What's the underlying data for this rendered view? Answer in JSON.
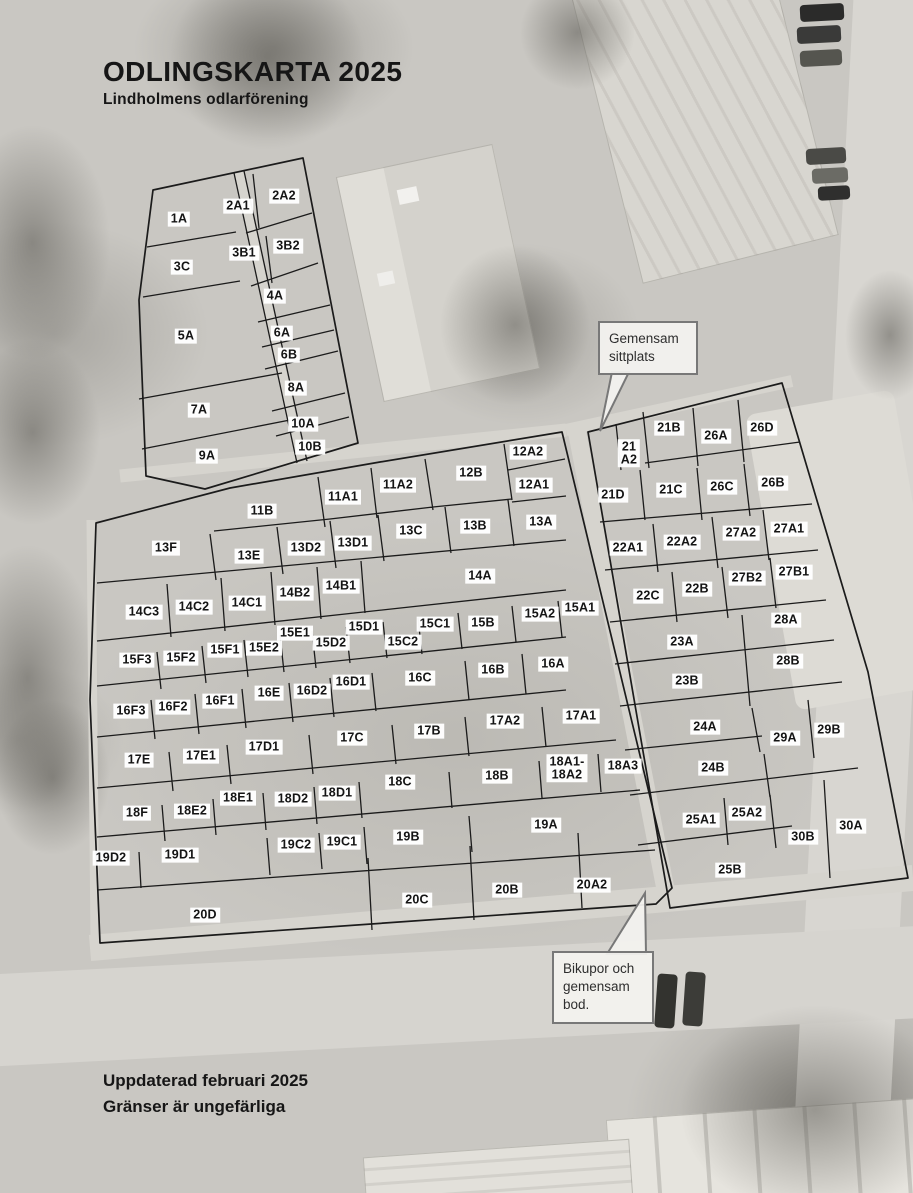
{
  "page": {
    "title": "ODLINGSKARTA 2025",
    "subtitle": "Lindholmens odlarförening",
    "footer_line1": "Uppdaterad februari 2025",
    "footer_line2": "Gränser är ungefärliga"
  },
  "callouts": {
    "sittplats": "Gemensam\nsittplats",
    "bikupor": "Bikupor och\ngemensam\nbod."
  },
  "map": {
    "plots": [
      {
        "label": "1A",
        "x": 179,
        "y": 219
      },
      {
        "label": "2A1",
        "x": 238,
        "y": 206
      },
      {
        "label": "2A2",
        "x": 284,
        "y": 196
      },
      {
        "label": "3C",
        "x": 182,
        "y": 267
      },
      {
        "label": "3B1",
        "x": 244,
        "y": 253
      },
      {
        "label": "3B2",
        "x": 288,
        "y": 246
      },
      {
        "label": "4A",
        "x": 275,
        "y": 296
      },
      {
        "label": "5A",
        "x": 186,
        "y": 336
      },
      {
        "label": "6A",
        "x": 282,
        "y": 333
      },
      {
        "label": "6B",
        "x": 289,
        "y": 355
      },
      {
        "label": "8A",
        "x": 296,
        "y": 388
      },
      {
        "label": "7A",
        "x": 199,
        "y": 410
      },
      {
        "label": "10A",
        "x": 303,
        "y": 424
      },
      {
        "label": "10B",
        "x": 310,
        "y": 447
      },
      {
        "label": "9A",
        "x": 207,
        "y": 456
      },
      {
        "label": "11B",
        "x": 262,
        "y": 511
      },
      {
        "label": "11A1",
        "x": 343,
        "y": 497
      },
      {
        "label": "11A2",
        "x": 398,
        "y": 485
      },
      {
        "label": "12B",
        "x": 471,
        "y": 473
      },
      {
        "label": "12A2",
        "x": 528,
        "y": 452
      },
      {
        "label": "12A1",
        "x": 534,
        "y": 485
      },
      {
        "label": "13F",
        "x": 166,
        "y": 548
      },
      {
        "label": "13E",
        "x": 249,
        "y": 556
      },
      {
        "label": "13D2",
        "x": 306,
        "y": 548
      },
      {
        "label": "13D1",
        "x": 353,
        "y": 543
      },
      {
        "label": "13C",
        "x": 411,
        "y": 531
      },
      {
        "label": "13B",
        "x": 475,
        "y": 526
      },
      {
        "label": "13A",
        "x": 541,
        "y": 522
      },
      {
        "label": "14A",
        "x": 480,
        "y": 576
      },
      {
        "label": "14B1",
        "x": 341,
        "y": 586
      },
      {
        "label": "14B2",
        "x": 295,
        "y": 593
      },
      {
        "label": "14C1",
        "x": 247,
        "y": 603
      },
      {
        "label": "14C2",
        "x": 194,
        "y": 607
      },
      {
        "label": "14C3",
        "x": 144,
        "y": 612
      },
      {
        "label": "15A1",
        "x": 580,
        "y": 608
      },
      {
        "label": "15A2",
        "x": 540,
        "y": 614
      },
      {
        "label": "15B",
        "x": 483,
        "y": 623
      },
      {
        "label": "15C1",
        "x": 435,
        "y": 624
      },
      {
        "label": "15C2",
        "x": 403,
        "y": 642
      },
      {
        "label": "15D1",
        "x": 364,
        "y": 627
      },
      {
        "label": "15D2",
        "x": 331,
        "y": 643
      },
      {
        "label": "15E1",
        "x": 295,
        "y": 633
      },
      {
        "label": "15E2",
        "x": 264,
        "y": 648
      },
      {
        "label": "15F1",
        "x": 225,
        "y": 650
      },
      {
        "label": "15F2",
        "x": 181,
        "y": 658
      },
      {
        "label": "15F3",
        "x": 137,
        "y": 660
      },
      {
        "label": "16A",
        "x": 553,
        "y": 664
      },
      {
        "label": "16B",
        "x": 493,
        "y": 670
      },
      {
        "label": "16C",
        "x": 420,
        "y": 678
      },
      {
        "label": "16D1",
        "x": 351,
        "y": 682
      },
      {
        "label": "16D2",
        "x": 312,
        "y": 691
      },
      {
        "label": "16E",
        "x": 269,
        "y": 693
      },
      {
        "label": "16F1",
        "x": 220,
        "y": 701
      },
      {
        "label": "16F2",
        "x": 173,
        "y": 707
      },
      {
        "label": "16F3",
        "x": 131,
        "y": 711
      },
      {
        "label": "17A1",
        "x": 581,
        "y": 716
      },
      {
        "label": "17A2",
        "x": 505,
        "y": 721
      },
      {
        "label": "17B",
        "x": 429,
        "y": 731
      },
      {
        "label": "17C",
        "x": 352,
        "y": 738
      },
      {
        "label": "17D1",
        "x": 264,
        "y": 747
      },
      {
        "label": "17E1",
        "x": 201,
        "y": 756
      },
      {
        "label": "17E",
        "x": 139,
        "y": 760
      },
      {
        "label": "18A1-\n18A2",
        "x": 567,
        "y": 768
      },
      {
        "label": "18A3",
        "x": 623,
        "y": 766
      },
      {
        "label": "18B",
        "x": 497,
        "y": 776
      },
      {
        "label": "18C",
        "x": 400,
        "y": 782
      },
      {
        "label": "18D1",
        "x": 337,
        "y": 793
      },
      {
        "label": "18D2",
        "x": 293,
        "y": 799
      },
      {
        "label": "18E1",
        "x": 238,
        "y": 798
      },
      {
        "label": "18E2",
        "x": 192,
        "y": 811
      },
      {
        "label": "18F",
        "x": 137,
        "y": 813
      },
      {
        "label": "19A",
        "x": 546,
        "y": 825
      },
      {
        "label": "19B",
        "x": 408,
        "y": 837
      },
      {
        "label": "19C1",
        "x": 342,
        "y": 842
      },
      {
        "label": "19C2",
        "x": 296,
        "y": 845
      },
      {
        "label": "19D1",
        "x": 180,
        "y": 855
      },
      {
        "label": "19D2",
        "x": 111,
        "y": 858
      },
      {
        "label": "20A2",
        "x": 592,
        "y": 885
      },
      {
        "label": "20B",
        "x": 507,
        "y": 890
      },
      {
        "label": "20C",
        "x": 417,
        "y": 900
      },
      {
        "label": "20D",
        "x": 205,
        "y": 915
      },
      {
        "label": "21\nA2",
        "x": 629,
        "y": 453
      },
      {
        "label": "21B",
        "x": 669,
        "y": 428
      },
      {
        "label": "26A",
        "x": 716,
        "y": 436
      },
      {
        "label": "26D",
        "x": 762,
        "y": 428
      },
      {
        "label": "21D",
        "x": 613,
        "y": 495
      },
      {
        "label": "21C",
        "x": 671,
        "y": 490
      },
      {
        "label": "26C",
        "x": 722,
        "y": 487
      },
      {
        "label": "26B",
        "x": 773,
        "y": 483
      },
      {
        "label": "22A1",
        "x": 628,
        "y": 548
      },
      {
        "label": "22A2",
        "x": 682,
        "y": 542
      },
      {
        "label": "27A2",
        "x": 741,
        "y": 533
      },
      {
        "label": "27A1",
        "x": 789,
        "y": 529
      },
      {
        "label": "22C",
        "x": 648,
        "y": 596
      },
      {
        "label": "22B",
        "x": 697,
        "y": 589
      },
      {
        "label": "27B2",
        "x": 747,
        "y": 578
      },
      {
        "label": "27B1",
        "x": 794,
        "y": 572
      },
      {
        "label": "23A",
        "x": 682,
        "y": 642
      },
      {
        "label": "28A",
        "x": 786,
        "y": 620
      },
      {
        "label": "23B",
        "x": 687,
        "y": 681
      },
      {
        "label": "28B",
        "x": 788,
        "y": 661
      },
      {
        "label": "24A",
        "x": 705,
        "y": 727
      },
      {
        "label": "29A",
        "x": 785,
        "y": 738
      },
      {
        "label": "29B",
        "x": 829,
        "y": 730
      },
      {
        "label": "24B",
        "x": 713,
        "y": 768
      },
      {
        "label": "25A1",
        "x": 701,
        "y": 820
      },
      {
        "label": "25A2",
        "x": 747,
        "y": 813
      },
      {
        "label": "30B",
        "x": 803,
        "y": 837
      },
      {
        "label": "30A",
        "x": 851,
        "y": 826
      },
      {
        "label": "25B",
        "x": 730,
        "y": 870
      }
    ]
  }
}
